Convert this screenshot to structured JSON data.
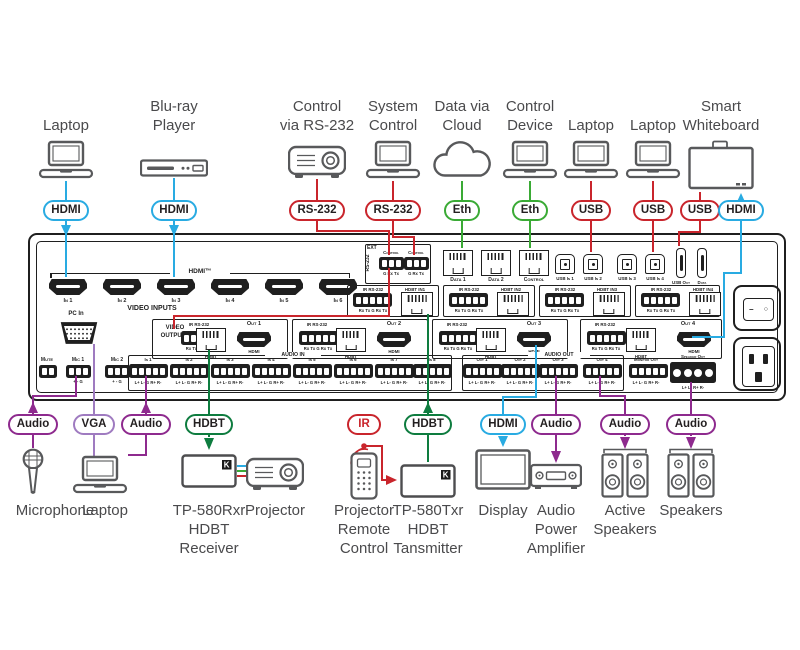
{
  "colors": {
    "hdmi": "#29abe2",
    "rs232": "#c9252c",
    "eth": "#3aaa35",
    "hdbt": "#0e7c3f",
    "audio": "#8e2a8e",
    "vga": "#9f7bc0",
    "panel_outline": "#1f1f1f",
    "device_outline": "#58595b",
    "label_text": "#4a4a4c"
  },
  "badges": [
    {
      "id": "hdmi-in1",
      "text": "HDMI",
      "type": "hdmi"
    },
    {
      "id": "hdmi-in3",
      "text": "HDMI",
      "type": "hdmi"
    },
    {
      "id": "rs232-ext",
      "text": "RS-232",
      "type": "rs232"
    },
    {
      "id": "rs232-ctrl",
      "text": "RS-232",
      "type": "rs232"
    },
    {
      "id": "eth-cloud",
      "text": "Eth",
      "type": "eth"
    },
    {
      "id": "eth-device",
      "text": "Eth",
      "type": "eth"
    },
    {
      "id": "usb-laptop1",
      "text": "USB",
      "type": "usb"
    },
    {
      "id": "usb-laptop2",
      "text": "USB",
      "type": "usb"
    },
    {
      "id": "usb-whiteboard",
      "text": "USB",
      "type": "usb"
    },
    {
      "id": "hdmi-whiteboard",
      "text": "HDMI",
      "type": "hdmi"
    },
    {
      "id": "audio-mic",
      "text": "Audio",
      "type": "audio"
    },
    {
      "id": "vga-laptop",
      "text": "VGA",
      "type": "vga"
    },
    {
      "id": "audio-laptop",
      "text": "Audio",
      "type": "audio"
    },
    {
      "id": "hdbt-receiver",
      "text": "HDBT",
      "type": "hdbt"
    },
    {
      "id": "ir-remote",
      "text": "IR",
      "type": "ir"
    },
    {
      "id": "hdbt-transmitter",
      "text": "HDBT",
      "type": "hdbt"
    },
    {
      "id": "hdmi-display",
      "text": "HDMI",
      "type": "hdmi"
    },
    {
      "id": "audio-amplifier",
      "text": "Audio",
      "type": "audio"
    },
    {
      "id": "audio-active-speakers",
      "text": "Audio",
      "type": "audio"
    },
    {
      "id": "audio-speakers",
      "text": "Audio",
      "type": "audio"
    }
  ],
  "top_devices": [
    {
      "id": "laptop-hdmi",
      "icon": "laptop",
      "label_lines": [
        "Laptop"
      ]
    },
    {
      "id": "bluray-player",
      "icon": "bluray",
      "label_lines": [
        "Blu-ray",
        "Player"
      ]
    },
    {
      "id": "control-rs232",
      "icon": "projector",
      "label_lines": [
        "Control",
        "via RS-232"
      ]
    },
    {
      "id": "system-control",
      "icon": "laptop",
      "label_lines": [
        "System",
        "Control"
      ]
    },
    {
      "id": "data-cloud",
      "icon": "cloud",
      "label_lines": [
        "Data via",
        "Cloud"
      ]
    },
    {
      "id": "control-device",
      "icon": "laptop",
      "label_lines": [
        "Control",
        "Device"
      ]
    },
    {
      "id": "laptop-usb-1",
      "icon": "laptop",
      "label_lines": [
        "Laptop"
      ]
    },
    {
      "id": "laptop-usb-2",
      "icon": "laptop",
      "label_lines": [
        "Laptop"
      ]
    },
    {
      "id": "smart-whiteboard",
      "icon": "whiteboard",
      "label_lines": [
        "Smart",
        "Whiteboard"
      ]
    }
  ],
  "bottom_devices": [
    {
      "id": "microphone",
      "icon": "microphone",
      "label_lines": [
        "Microphone"
      ]
    },
    {
      "id": "laptop-vga",
      "icon": "laptop",
      "label_lines": [
        "Laptop"
      ]
    },
    {
      "id": "tp-580rxr",
      "icon": "extender",
      "label_lines": [
        "TP-580Rxr",
        "HDBT",
        "Receiver"
      ]
    },
    {
      "id": "projector",
      "icon": "projector",
      "label_lines": [
        "Projector"
      ]
    },
    {
      "id": "remote-control",
      "icon": "remote",
      "label_lines": [
        "Projector",
        "Remote",
        "Control"
      ]
    },
    {
      "id": "tp-580txr",
      "icon": "extender",
      "label_lines": [
        "TP-580Txr",
        "HDBT",
        "Tansmitter"
      ]
    },
    {
      "id": "display",
      "icon": "display",
      "label_lines": [
        "Display"
      ]
    },
    {
      "id": "amplifier",
      "icon": "amplifier",
      "label_lines": [
        "Audio",
        "Power",
        "Amplifier"
      ]
    },
    {
      "id": "active-speakers",
      "icon": "speakers",
      "label_lines": [
        "Active",
        "Speakers"
      ]
    },
    {
      "id": "speakers",
      "icon": "speakers",
      "label_lines": [
        "Speakers"
      ]
    }
  ],
  "panel": {
    "hdmi_group_label": "HDMI™",
    "hdmi_inputs": [
      "In 1",
      "In 2",
      "In 3",
      "In 4",
      "In 5",
      "In 6"
    ],
    "video_inputs_label": "VIDEO INPUTS",
    "pc_in_label": "PC In",
    "ext_block": {
      "title": "EXT",
      "side_label": "RS-232",
      "port_labels": [
        "Control",
        "Control"
      ],
      "pin_labels": [
        "G Rx Tx",
        "G Rx Tx"
      ]
    },
    "lan_ports": [
      "Data 1",
      "Data 2",
      "Control"
    ],
    "usb_in_ports": [
      "USB In 1",
      "USB In 2",
      "USB In 3",
      "USB In 4"
    ],
    "usb_aux_ports": [
      "USB Out",
      "Data"
    ],
    "hdbt_inputs": [
      {
        "ir": "IR RS-232",
        "pins": "Rx Tx G Rx Tx",
        "port": "HDBT IN1"
      },
      {
        "ir": "IR RS-232",
        "pins": "Rx Tx G Rx Tx",
        "port": "HDBT IN2"
      },
      {
        "ir": "IR RS-232",
        "pins": "Rx Tx G Rx Tx",
        "port": "HDBT IN3"
      },
      {
        "ir": "IR RS-232",
        "pins": "Rx Tx G Rx Tx",
        "port": "HDBT IN4"
      }
    ],
    "video_outputs_label": "VIDEO OUTPUTS",
    "video_outputs": [
      {
        "name": "Out 1",
        "ir": "IR RS-232",
        "pins": "Rx Tx G Rx Tx",
        "hdbt": "HDBT",
        "hdmi": "HDMI"
      },
      {
        "name": "Out 2",
        "ir": "IR RS-232",
        "pins": "Rx Tx G Rx Tx",
        "hdbt": "HDBT",
        "hdmi": "HDMI"
      },
      {
        "name": "Out 3",
        "ir": "IR RS-232",
        "pins": "Rx Tx G Rx Tx",
        "hdbt": "HDBT",
        "hdmi": "HDMI"
      },
      {
        "name": "Out 4",
        "ir": "IR RS-232",
        "pins": "Rx Tx G Rx Tx",
        "hdbt": "HDBT",
        "hdmi": "HDMI"
      }
    ],
    "audio": {
      "mute": "Mute",
      "mics": [
        "Mic 1",
        "Mic 2"
      ],
      "mic_pins": "+ - G",
      "in_label": "AUDIO IN",
      "inputs": [
        "In 1",
        "In 2",
        "In 3",
        "In 4",
        "In 5",
        "In 6",
        "In 7",
        "In 8"
      ],
      "line_pins": "L+ L- G R+ R-",
      "out_label": "AUDIO OUT",
      "outputs": [
        "Out 1",
        "Out 2",
        "Out 3",
        "Out 4"
      ],
      "monitor": "Monitor Out",
      "speaker": "Speaker Out",
      "speaker_pins": "L+ L- R+ R-"
    }
  }
}
